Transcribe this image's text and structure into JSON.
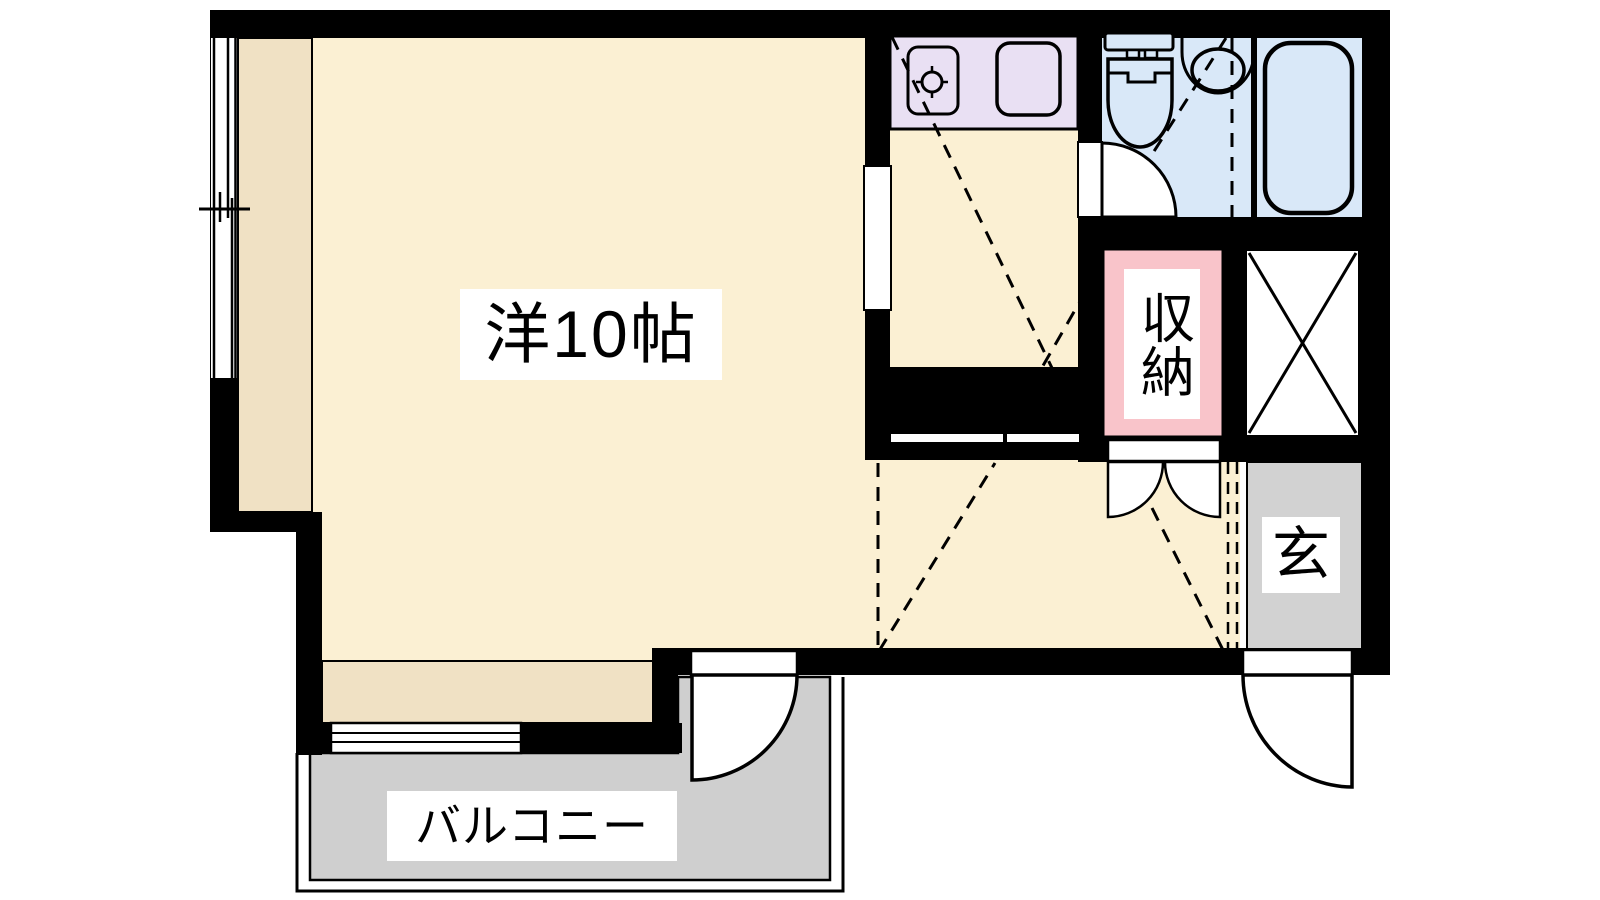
{
  "labels": {
    "main_room": "洋10帖",
    "storage": "収納",
    "entrance": "玄",
    "balcony": "バルコニー"
  },
  "colors": {
    "wall": "#000000",
    "room_floor": "#FBF0D3",
    "floor_accent": "#F0E1C4",
    "kitchen_counter": "#E9E0F3",
    "bathroom_floor": "#D9E8F8",
    "storage": "#F9C4CA",
    "entrance_floor": "#D2D2D2",
    "balcony_floor": "#CFCFCF"
  }
}
